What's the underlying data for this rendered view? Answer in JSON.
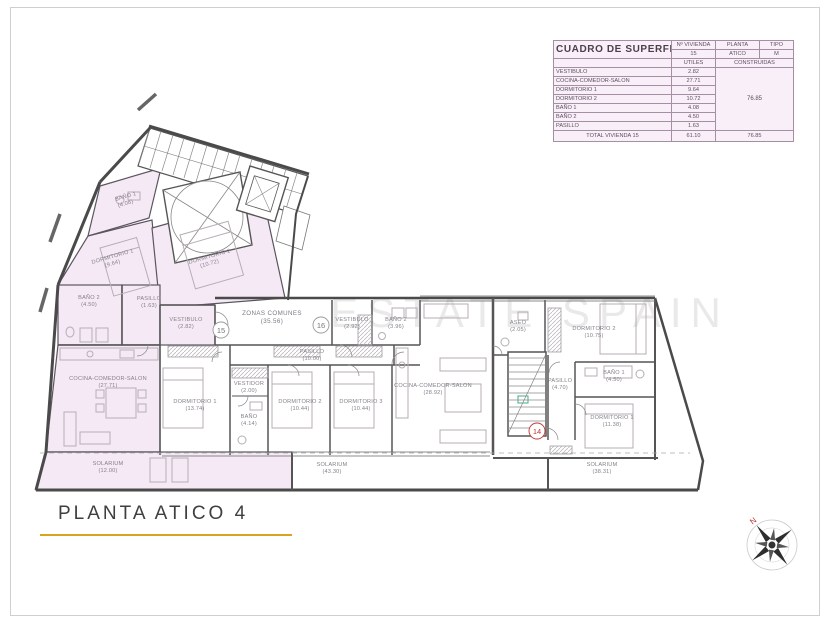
{
  "title": {
    "text": "PLANTA ATICO 4"
  },
  "watermark": "ESTATE SPAIN",
  "surface_table": {
    "title": "CUADRO DE SUPERFICIES",
    "col_vivienda_label": "Nº VIVIENDA",
    "col_vivienda_value": "15",
    "col_planta_label": "PLANTA",
    "col_planta_value": "ATICO",
    "col_tipo_label": "TIPO",
    "col_tipo_value": "M",
    "col_utiles": "UTILES",
    "col_construidas": "CONSTRUIDAS",
    "rows": [
      {
        "name": "VESTIBULO",
        "utiles": "2.82"
      },
      {
        "name": "COCINA-COMEDOR-SALON",
        "utiles": "27.71"
      },
      {
        "name": "DORMITORIO 1",
        "utiles": "9.64"
      },
      {
        "name": "DORMITORIO 2",
        "utiles": "10.72"
      },
      {
        "name": "BAÑO 1",
        "utiles": "4.08"
      },
      {
        "name": "BAÑO 2",
        "utiles": "4.50"
      },
      {
        "name": "PASILLO",
        "utiles": "1.63"
      }
    ],
    "construidas_value": "76.85",
    "total_label": "TOTAL VIVIENDA 15",
    "total_utiles": "61.10",
    "total_construidas": "76.85"
  },
  "plan": {
    "labels": [
      {
        "name": "BAÑO 1",
        "area": "(4.08)"
      },
      {
        "name": "DORMITORIO 1",
        "area": "(9.64)"
      },
      {
        "name": "DORMITORIO 2",
        "area": "(10.72)"
      },
      {
        "name": "BAÑO 2",
        "area": "(4.50)"
      },
      {
        "name": "PASILLO",
        "area": "(1.63)"
      },
      {
        "name": "VESTIBULO",
        "area": "(2.82)"
      },
      {
        "name": "COCINA-COMEDOR-SALON",
        "area": "(27.71)"
      },
      {
        "name": "SOLARIUM",
        "area": "(12.00)"
      },
      {
        "name": "ZONAS COMUNES",
        "area": "(35.56)"
      },
      {
        "name": "PASILLO",
        "area": "(10.00)"
      },
      {
        "name": "DORMITORIO 1",
        "area": "(13.74)"
      },
      {
        "name": "VESTIDOR",
        "area": "(2.00)"
      },
      {
        "name": "BAÑO",
        "area": "(4.14)"
      },
      {
        "name": "DORMITORIO 2",
        "area": "(10.44)"
      },
      {
        "name": "DORMITORIO 3",
        "area": "(10.44)"
      },
      {
        "name": "VESTIBULO",
        "area": "(2.92)"
      },
      {
        "name": "BAÑO 2",
        "area": "(3.96)"
      },
      {
        "name": "COCINA-COMEDOR-SALON",
        "area": "(28.92)"
      },
      {
        "name": "SOLARIUM",
        "area": "(43.30)"
      },
      {
        "name": "ASEO",
        "area": "(2.05)"
      },
      {
        "name": "DORMITORIO 2",
        "area": "(10.75)"
      },
      {
        "name": "PASILLO",
        "area": "(4.70)"
      },
      {
        "name": "BAÑO 1",
        "area": "(4.50)"
      },
      {
        "name": "DORMITORIO 1",
        "area": "(11.38)"
      },
      {
        "name": "SOLARIUM",
        "area": "(38.31)"
      }
    ],
    "badges": [
      {
        "number": "15"
      },
      {
        "number": "16"
      },
      {
        "number": "14"
      }
    ],
    "compass_north": "N"
  },
  "colors": {
    "highlight": "#f6e9f6",
    "accent_gold": "#d8a41e",
    "badge_red": "#c23434"
  }
}
